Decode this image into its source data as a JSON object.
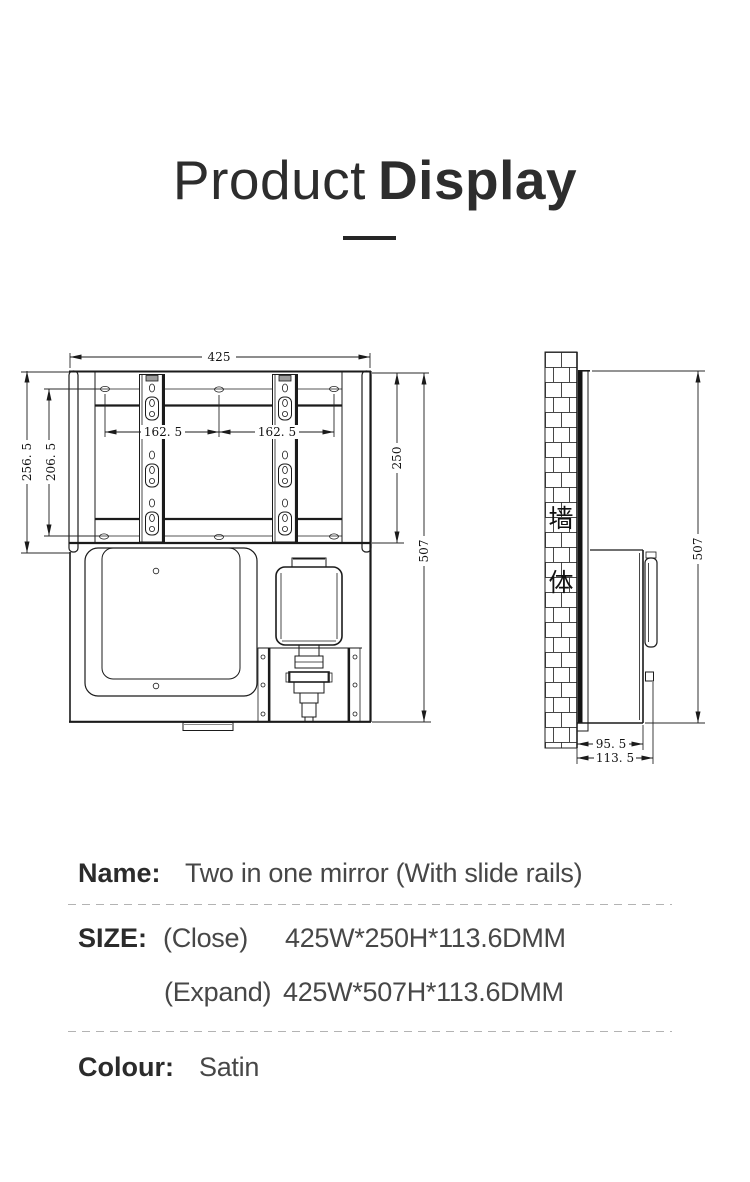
{
  "title": {
    "light": "Product",
    "bold": "Display"
  },
  "drawing": {
    "front_view": {
      "width": "425",
      "hole_pitch_left": "162. 5",
      "hole_pitch_right": "162. 5",
      "height_overall_left": "256. 5",
      "height_holes": "206. 5",
      "height_closed": "250",
      "height_expanded": "507"
    },
    "side_view": {
      "height_expanded": "507",
      "depth_body": "95. 5",
      "depth_overall": "113. 5",
      "wall_char_top": "墙",
      "wall_char_bottom": "体"
    }
  },
  "info": {
    "name_label": "Name:",
    "name_value": "Two in one mirror  (With slide rails)",
    "size_label": "SIZE:",
    "size_close_prefix": "(Close)",
    "size_close_value": "425W*250H*113.6DMM",
    "size_expand_prefix": "(Expand)",
    "size_expand_value": "425W*507H*113.6DMM",
    "colour_label": "Colour:",
    "colour_value": "Satin"
  },
  "colors": {
    "text_dark": "#2b2b2b",
    "text_value": "#474747",
    "line": "#1b1b1b",
    "divider_dash": "#b3b3b3"
  }
}
